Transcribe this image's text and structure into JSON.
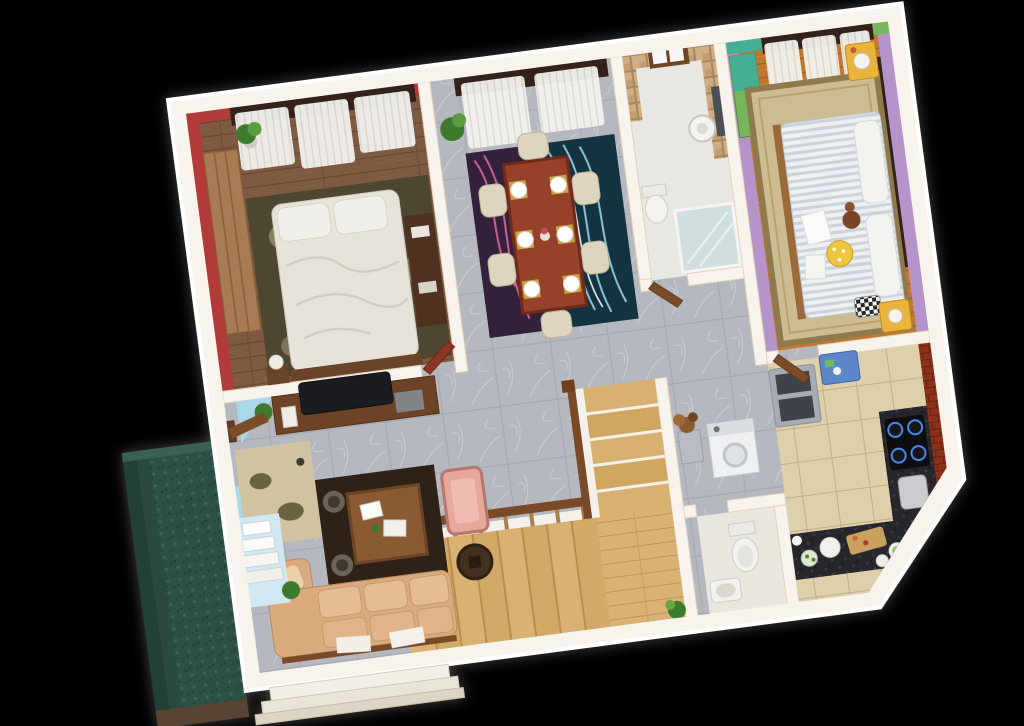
{
  "scene": {
    "type": "3d-rendered-isometric-floor-plan",
    "background": "#000000",
    "plan_rotation_deg": -7.5,
    "no_visible_text": true
  },
  "rooms": {
    "bedroom_1": {
      "name": "master-bedroom",
      "furniture": [
        "wardrobe",
        "double-bed-white-duvet",
        "pillows",
        "olive-rug",
        "dresser",
        "bedside-lamp",
        "potted-plant",
        "curtained-windows"
      ]
    },
    "dining_room": {
      "name": "dining-room",
      "furniture": [
        "dining-table-6-seats",
        "place-settings",
        "two-tone-wave-rug",
        "potted-plant",
        "curtained-windows"
      ]
    },
    "bathroom_1": {
      "name": "bathroom",
      "furniture": [
        "pedestal-basin",
        "mirror",
        "toilet",
        "glass-shower",
        "mosaic-walls",
        "window"
      ]
    },
    "bedroom_2": {
      "name": "kids-bedroom",
      "furniture": [
        "striped-duvet-bed",
        "pillows",
        "teddy-bear",
        "polka-dot-cushion",
        "checker-cushion",
        "yellow-nightstands",
        "alarm-clock",
        "green-wardrobe",
        "oriental-rug",
        "curtained-windows"
      ]
    },
    "kitchen": {
      "name": "kitchen",
      "furniture": [
        "refrigerator",
        "blue-prep-table",
        "l-shaped-granite-counter",
        "gas-hob",
        "cutting-board",
        "plates",
        "jars",
        "brick-walls"
      ]
    },
    "utility_wc": {
      "name": "utility-and-wc",
      "furniture": [
        "washing-machine",
        "flower-pedestal",
        "toilet",
        "wash-basin"
      ]
    },
    "staircase": {
      "name": "staircase",
      "furniture": [
        "lower-flight",
        "landing",
        "upper-flight",
        "handrail",
        "balusters",
        "potted-plant"
      ]
    },
    "living_room": {
      "name": "living-room",
      "furniture": [
        "tv-unit",
        "television",
        "coffee-table",
        "magazines",
        "accent-chairs",
        "pink-armchair",
        "round-side-table",
        "tan-sofa",
        "throw-pillows",
        "rugs",
        "potted-plants"
      ]
    },
    "entrance": {
      "name": "entrance-foyer",
      "furniture": [
        "wooden-door",
        "fan-steps",
        "beige-rug",
        "potted-plant"
      ]
    },
    "exterior": {
      "name": "exterior",
      "features": [
        "terraced-lawn",
        "porch-steps"
      ]
    }
  },
  "colors": {
    "background": "#000000",
    "outer_wall": "#f8f4ed",
    "wall_shadow": "#e2d3ba",
    "red_wall": "#b23a38",
    "cream_wall": "#e8d6ba",
    "lavender_wall": "#b494c9",
    "teal_accent": "#46ae93",
    "green_accent": "#76b55c",
    "valance": "#33211a",
    "olive_rug": "#4d4732",
    "dining_rug_left": "#33203a",
    "dining_rug_right": "#143340",
    "dining_table": "#97402a",
    "chair_cream": "#ddd5bf",
    "oriental_rug": "#cdbb92",
    "nightstand_yellow": "#e9b33c",
    "polka_cushion": "#eec53f",
    "teddy_brown": "#7a4526",
    "brick_wall": "#8c3019",
    "granite_counter": "#26262c",
    "fridge_steel": "#a7abb2",
    "fridge_panel": "#3e434a",
    "blue_table": "#5b86c9",
    "sofa_tan": "#d9aa7e",
    "sofa_cushion": "#e5bd93",
    "armchair_pink": "#e7a79c",
    "tv_black": "#1b1c1f",
    "tv_unit_wood": "#6e4226",
    "coffee_table": "#8a5a32",
    "dark_rug": "#2e2118",
    "foyer_rug": "#cfc3a2",
    "side_table": "#43301f",
    "stair_rail": "#7a4a28",
    "stair_tread": "#d9b273",
    "door_wood": "#7c4b28",
    "door_red": "#8f3526",
    "entry_blue": "#a9d8e8",
    "lawn_green": "#2c5045",
    "earth_brown": "#584434",
    "plant_green": "#3e7a2e",
    "bed_white": "#e7e3da",
    "shower_glass": "#bcd7de",
    "porcelain": "#f3f2ef"
  }
}
